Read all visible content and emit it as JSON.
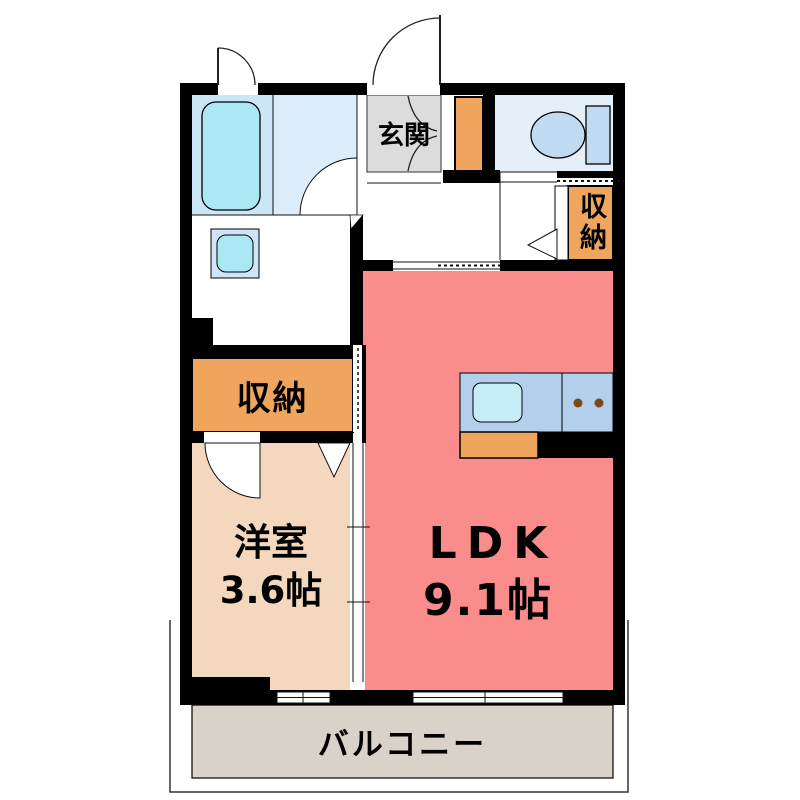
{
  "title": "apartment-floor-plan",
  "rooms": {
    "entrance": {
      "label": "玄関"
    },
    "storage_upper": {
      "label": "収納"
    },
    "storage_lower": {
      "label": "収納"
    },
    "western_room": {
      "label": "洋室",
      "size": "3.6帖"
    },
    "ldk": {
      "label": "LDK",
      "size": "9.1帖"
    },
    "balcony": {
      "label": "バルコニー"
    }
  },
  "fixtures": [
    "bathtub",
    "washbasin",
    "toilet",
    "kitchen-sink",
    "gas-stove",
    "shoe-cabinet"
  ],
  "colors": {
    "wall": "#000000",
    "ldk_floor": "#fa8c8c",
    "western_room_floor": "#f3d8bd",
    "storage_fill": "#efa55e",
    "entrance_fill": "#dcdcdc",
    "balcony_fill": "#d8d2c9",
    "bathroom_fill": "#cbe6f6",
    "washroom_fill": "#dcecf9",
    "toilet_room_fill": "#e4effa",
    "fixture_blue": "#c0daf2",
    "tub_sink_cyan": "#aae8f3",
    "kitchen_counter": "#b4cfec",
    "burner_brown": "#7a4a12"
  }
}
